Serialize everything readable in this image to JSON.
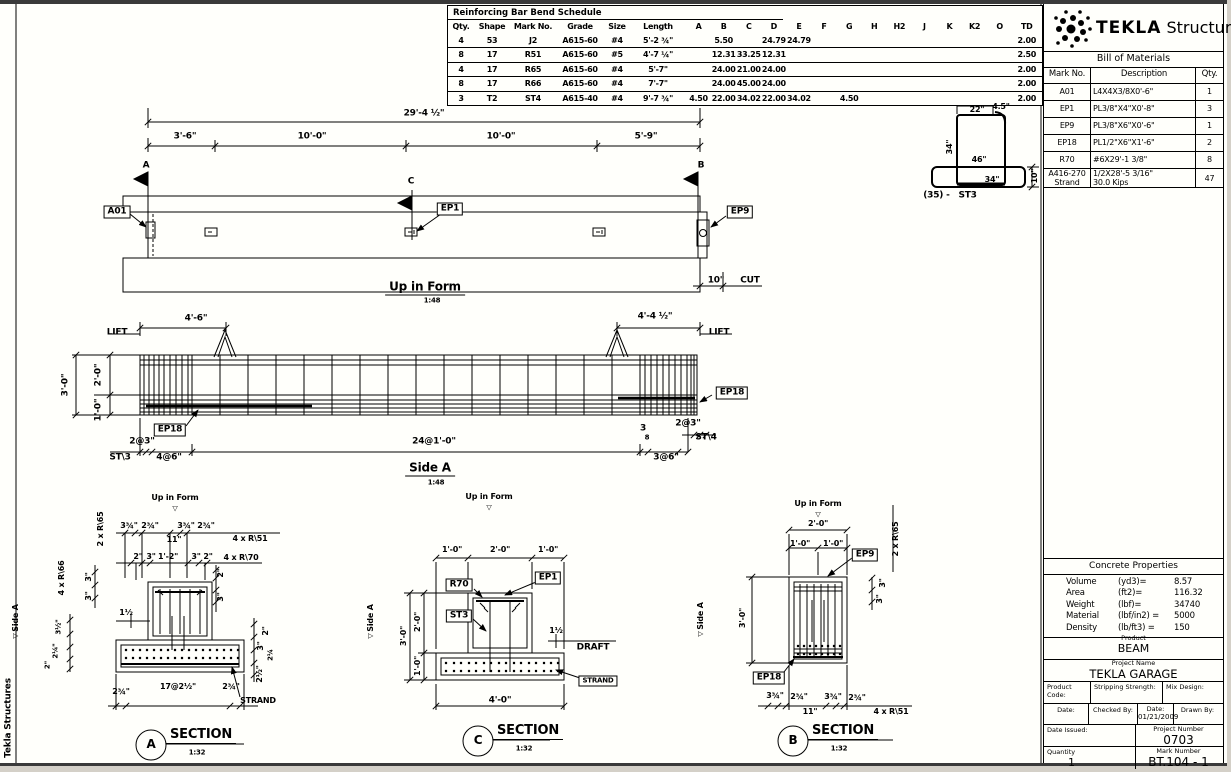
{
  "schedule": {
    "title": "Reinforcing Bar Bend Schedule",
    "head": [
      [
        "Qty.",
        "Shape",
        "Mark No.",
        "Grade",
        "Size",
        "Length",
        "A",
        "B",
        "C",
        "D",
        "E",
        "F",
        "G",
        "H",
        "H2",
        "J",
        "K",
        "K2",
        "O",
        "TD"
      ]
    ],
    "rows": [
      [
        "4",
        "53",
        "J2",
        "A615-60",
        "#4",
        "5'-2 ¾\"",
        "",
        "5.50",
        "",
        "24.79",
        "24.79",
        "",
        "",
        "",
        "",
        "",
        "",
        "",
        "",
        "2.00"
      ],
      [
        "8",
        "17",
        "R51",
        "A615-60",
        "#5",
        "4'-7 ¼\"",
        "",
        "12.31",
        "33.25",
        "12.31",
        "",
        "",
        "",
        "",
        "",
        "",
        "",
        "",
        "",
        "2.50"
      ],
      [
        "4",
        "17",
        "R65",
        "A615-60",
        "#4",
        "5'-7\"",
        "",
        "24.00",
        "21.00",
        "24.00",
        "",
        "",
        "",
        "",
        "",
        "",
        "",
        "",
        "",
        "2.00"
      ],
      [
        "8",
        "17",
        "R66",
        "A615-60",
        "#4",
        "7'-7\"",
        "",
        "24.00",
        "45.00",
        "24.00",
        "",
        "",
        "",
        "",
        "",
        "",
        "",
        "",
        "",
        "2.00"
      ],
      [
        "3",
        "T2",
        "ST4",
        "A615-40",
        "#4",
        "9'-7 ¾\"",
        "4.50",
        "22.00",
        "34.02",
        "22.00",
        "34.02",
        "",
        "4.50",
        "",
        "",
        "",
        "",
        "",
        "",
        "2.00"
      ]
    ]
  },
  "brand": {
    "name_bold": "TEKLA",
    "name_light": " Structures"
  },
  "bom": {
    "title": "Bill of Materials",
    "head": [
      [
        "Mark No.",
        "Description",
        "Qty."
      ]
    ],
    "rows": [
      [
        "A01",
        "L4X4X3/8X0'-6\"",
        "1"
      ],
      [
        "EP1",
        "PL3/8\"X4\"X0'-8\"",
        "3"
      ],
      [
        "EP9",
        "PL3/8\"X6\"X0'-6\"",
        "1"
      ],
      [
        "EP18",
        "PL1/2\"X6\"X1'-6\"",
        "2"
      ],
      [
        "R70",
        "#6X29'-1 3/8\"",
        "8"
      ],
      [
        "A416-270\nStrand",
        "1/2X28'-5 3/16\"\n30.0 Kips",
        "47"
      ]
    ]
  },
  "concrete": {
    "title": "Concrete Properties",
    "rows": [
      [
        "Volume",
        "(yd3)=",
        "8.57"
      ],
      [
        "Area",
        "(ft2)=",
        "116.32"
      ],
      [
        "Weight",
        "(lbf)=",
        "34740"
      ],
      [
        "Material",
        "(lbf/in2) =",
        "5000"
      ],
      [
        "Density",
        "(lb/ft3) =",
        "150"
      ]
    ]
  },
  "titleblock": {
    "product_label": "Product",
    "product": "BEAM",
    "project_label": "Project Name",
    "project": "TEKLA GARAGE",
    "product_code_label": "Product Code:",
    "stripping_label": "Stripping Strength:",
    "mix_label": "Mix Design:",
    "date_label": "Date:",
    "checked_label": "Checked By:",
    "date2_label": "Date:",
    "date2": "01/21/2009",
    "drawn_label": "Drawn By:",
    "date_issued_label": "Date Issued:",
    "project_number_label": "Project Number",
    "project_number": "0703",
    "quantity_label": "Quantity",
    "quantity": "1",
    "mark_number_label": "Mark Number",
    "mark_number": "BT.104 - 1"
  },
  "annotations": [
    {
      "n": "dim-overall-length",
      "t": "29'-4 ½\"",
      "x": 424,
      "y": 114
    },
    {
      "n": "dim-seg-1",
      "t": "3'-6\"",
      "x": 185,
      "y": 137
    },
    {
      "n": "dim-seg-2",
      "t": "10'-0\"",
      "x": 312,
      "y": 137
    },
    {
      "n": "dim-seg-3",
      "t": "10'-0\"",
      "x": 501,
      "y": 137
    },
    {
      "n": "dim-seg-4",
      "t": "5'-9\"",
      "x": 646,
      "y": 137
    },
    {
      "n": "section-mark-a",
      "t": "A",
      "x": 146,
      "y": 166
    },
    {
      "n": "section-mark-c",
      "t": "C",
      "x": 411,
      "y": 182
    },
    {
      "n": "section-mark-b",
      "t": "B",
      "x": 701,
      "y": 166
    },
    {
      "n": "label-a01",
      "t": "A01",
      "x": 117,
      "y": 212,
      "box": 1
    },
    {
      "n": "label-ep1",
      "t": "EP1",
      "x": 450,
      "y": 209,
      "box": 1
    },
    {
      "n": "label-ep9",
      "t": "EP9",
      "x": 740,
      "y": 212,
      "box": 1
    },
    {
      "n": "title-up-in-form",
      "t": "Up in Form",
      "x": 425,
      "y": 288,
      "s": 12,
      "u": 1
    },
    {
      "n": "scale-up-in-form",
      "t": "1:48",
      "x": 432,
      "y": 301,
      "s": 7
    },
    {
      "n": "dim-cut",
      "t": "10\"",
      "x": 716,
      "y": 281
    },
    {
      "n": "label-cut",
      "t": "CUT",
      "x": 750,
      "y": 281
    },
    {
      "n": "label-lift-left",
      "t": "LIFT",
      "x": 117,
      "y": 333
    },
    {
      "n": "dim-lift-left",
      "t": "4'-6\"",
      "x": 196,
      "y": 319
    },
    {
      "n": "dim-lift-right",
      "t": "4'-4 ½\"",
      "x": 655,
      "y": 317
    },
    {
      "n": "label-lift-right",
      "t": "LIFT",
      "x": 719,
      "y": 333
    },
    {
      "n": "dim-sidea-depth",
      "t": "3'-0\"",
      "x": 66,
      "y": 385,
      "r": 1
    },
    {
      "n": "dim-sidea-upper",
      "t": "2'-0\"",
      "x": 99,
      "y": 375,
      "r": 1
    },
    {
      "n": "dim-sidea-lower",
      "t": "1'-0\"",
      "x": 99,
      "y": 410,
      "r": 1
    },
    {
      "n": "label-ep18-sidea-left",
      "t": "EP18",
      "x": 170,
      "y": 430,
      "box": 1
    },
    {
      "n": "label-ep18-sidea-right",
      "t": "EP18",
      "x": 732,
      "y": 393,
      "box": 1
    },
    {
      "n": "dim-spacing-left-1",
      "t": "2@3\"",
      "x": 142,
      "y": 442
    },
    {
      "n": "label-st3-sidea",
      "t": "ST\\3",
      "x": 120,
      "y": 458
    },
    {
      "n": "dim-spacing-left-2",
      "t": "4@6\"",
      "x": 169,
      "y": 458
    },
    {
      "n": "dim-spacing-mid",
      "t": "24@1'-0\"",
      "x": 434,
      "y": 442
    },
    {
      "n": "dim-gap-num",
      "t": "3",
      "x": 643,
      "y": 429,
      "s": 9
    },
    {
      "n": "dim-gap-den",
      "t": "8",
      "x": 647,
      "y": 438,
      "s": 7
    },
    {
      "n": "dim-spacing-right-2",
      "t": "3@6\"",
      "x": 666,
      "y": 458
    },
    {
      "n": "dim-spacing-right-1",
      "t": "2@3\"",
      "x": 688,
      "y": 424
    },
    {
      "n": "label-st4-sidea",
      "t": "ST\\4",
      "x": 706,
      "y": 438
    },
    {
      "n": "title-side-a",
      "t": "Side A",
      "x": 430,
      "y": 469,
      "s": 12,
      "u": 1
    },
    {
      "n": "scale-side-a",
      "t": "1:48",
      "x": 436,
      "y": 483,
      "s": 7
    },
    {
      "n": "label-up-in-form-a",
      "t": "Up in Form",
      "x": 175,
      "y": 498,
      "s": 8
    },
    {
      "n": "up-arrow-a",
      "t": "▽",
      "x": 175,
      "y": 509,
      "s": 7
    },
    {
      "n": "label-2xr65-a",
      "t": "2 x R\\65",
      "x": 101,
      "y": 529,
      "r": 1,
      "s": 8
    },
    {
      "n": "dim-a-top-1",
      "t": "3¾\"",
      "x": 129,
      "y": 526,
      "s": 8
    },
    {
      "n": "dim-a-top-2",
      "t": "2¾\"",
      "x": 150,
      "y": 526,
      "s": 8
    },
    {
      "n": "dim-a-top-11",
      "t": "11\"",
      "x": 174,
      "y": 540,
      "s": 8
    },
    {
      "n": "dim-a-top-3",
      "t": "3¾\"",
      "x": 186,
      "y": 526,
      "s": 8
    },
    {
      "n": "dim-a-top-4",
      "t": "2¾\"",
      "x": 206,
      "y": 526,
      "s": 8
    },
    {
      "n": "label-4xr51-a",
      "t": "4 x R\\51",
      "x": 250,
      "y": 539,
      "s": 8
    },
    {
      "n": "dim-a-mid-1",
      "t": "2\"",
      "x": 138,
      "y": 557,
      "s": 8
    },
    {
      "n": "dim-a-mid-2",
      "t": "3\"",
      "x": 151,
      "y": 557,
      "s": 8
    },
    {
      "n": "dim-a-mid-3",
      "t": "1'-2\"",
      "x": 168,
      "y": 557,
      "s": 8
    },
    {
      "n": "dim-a-mid-4",
      "t": "3\"",
      "x": 196,
      "y": 557,
      "s": 8
    },
    {
      "n": "dim-a-mid-5",
      "t": "2\"",
      "x": 208,
      "y": 557,
      "s": 8
    },
    {
      "n": "label-4xr70-a",
      "t": "4 x R\\70",
      "x": 241,
      "y": 558,
      "s": 8
    },
    {
      "n": "dim-a-left-3a",
      "t": "3\"",
      "x": 89,
      "y": 577,
      "r": 1,
      "s": 8
    },
    {
      "n": "dim-a-left-3b",
      "t": "3\"",
      "x": 89,
      "y": 596,
      "r": 1,
      "s": 8
    },
    {
      "n": "label-4xr66-a",
      "t": "4 x R\\66",
      "x": 62,
      "y": 578,
      "r": 1,
      "s": 8
    },
    {
      "n": "dim-a-right-2",
      "t": "2\"",
      "x": 221,
      "y": 573,
      "r": 1,
      "s": 8
    },
    {
      "n": "dim-a-right-3",
      "t": "3\"",
      "x": 221,
      "y": 597,
      "r": 1,
      "s": 8
    },
    {
      "n": "dim-a-draft",
      "t": "1½",
      "x": 126,
      "y": 613,
      "s": 8
    },
    {
      "n": "dim-a-strand-r1",
      "t": "2\"",
      "x": 266,
      "y": 631,
      "r": 1,
      "s": 8
    },
    {
      "n": "dim-a-strand-r2",
      "t": "3\"",
      "x": 261,
      "y": 646,
      "r": 1,
      "s": 8
    },
    {
      "n": "dim-a-strand-r3",
      "t": "2¼",
      "x": 271,
      "y": 655,
      "r": 1,
      "s": 7
    },
    {
      "n": "dim-a-strand-r4",
      "t": "2½\"",
      "x": 260,
      "y": 674,
      "r": 1,
      "s": 8
    },
    {
      "n": "dim-a-strand-l1",
      "t": "3½\"",
      "x": 59,
      "y": 627,
      "r": 1,
      "s": 7
    },
    {
      "n": "dim-a-strand-l2",
      "t": "2¼\"",
      "x": 56,
      "y": 651,
      "r": 1,
      "s": 7
    },
    {
      "n": "dim-a-strand-l3",
      "t": "2\"",
      "x": 48,
      "y": 665,
      "r": 1,
      "s": 7
    },
    {
      "n": "dim-a-bot-1",
      "t": "2¾\"",
      "x": 121,
      "y": 692,
      "s": 8
    },
    {
      "n": "dim-a-bot-2",
      "t": "17@2½\"",
      "x": 178,
      "y": 687,
      "s": 8
    },
    {
      "n": "dim-a-bot-3",
      "t": "2¾\"",
      "x": 231,
      "y": 687,
      "s": 8
    },
    {
      "n": "label-strand-a",
      "t": "STRAND",
      "x": 258,
      "y": 701,
      "s": 8
    },
    {
      "n": "section-a-letter",
      "t": "A",
      "x": 151,
      "y": 744,
      "s": 12
    },
    {
      "n": "section-a-title",
      "t": "SECTION",
      "x": 201,
      "y": 736,
      "s": 13,
      "u": 1
    },
    {
      "n": "section-a-scale",
      "t": "1:32",
      "x": 197,
      "y": 753,
      "s": 7
    },
    {
      "n": "marker-side-a-1",
      "t": "Side A",
      "x": 16,
      "y": 618,
      "r": 1,
      "s": 8
    },
    {
      "n": "marker-side-a-1t",
      "t": "▽",
      "x": 16,
      "y": 636,
      "r": 1,
      "s": 7
    },
    {
      "n": "marker-side-a-2",
      "t": "Side A",
      "x": 371,
      "y": 618,
      "r": 1,
      "s": 8
    },
    {
      "n": "marker-side-a-2t",
      "t": "▽",
      "x": 371,
      "y": 636,
      "r": 1,
      "s": 7
    },
    {
      "n": "label-up-in-form-c",
      "t": "Up in Form",
      "x": 489,
      "y": 497,
      "s": 8
    },
    {
      "n": "up-arrow-c",
      "t": "▽",
      "x": 489,
      "y": 508,
      "s": 7
    },
    {
      "n": "dim-c-top-1",
      "t": "1'-0\"",
      "x": 452,
      "y": 550,
      "s": 8
    },
    {
      "n": "dim-c-top-2",
      "t": "2'-0\"",
      "x": 500,
      "y": 550,
      "s": 8
    },
    {
      "n": "dim-c-top-3",
      "t": "1'-0\"",
      "x": 548,
      "y": 550,
      "s": 8
    },
    {
      "n": "label-r70-c",
      "t": "R70",
      "x": 459,
      "y": 585,
      "box": 1
    },
    {
      "n": "label-ep1-c",
      "t": "EP1",
      "x": 548,
      "y": 578,
      "box": 1
    },
    {
      "n": "label-st3-c",
      "t": "ST3",
      "x": 459,
      "y": 616,
      "box": 1
    },
    {
      "n": "dim-c-depth",
      "t": "3'-0\"",
      "x": 404,
      "y": 636,
      "r": 1,
      "s": 8
    },
    {
      "n": "dim-c-upper",
      "t": "2'-0\"",
      "x": 418,
      "y": 622,
      "r": 1,
      "s": 8
    },
    {
      "n": "dim-c-lower",
      "t": "1'-0\"",
      "x": 418,
      "y": 666,
      "r": 1,
      "s": 8
    },
    {
      "n": "dim-c-draft",
      "t": "1½",
      "x": 556,
      "y": 631,
      "s": 8
    },
    {
      "n": "label-draft-c",
      "t": "DRAFT",
      "x": 593,
      "y": 648,
      "s": 9
    },
    {
      "n": "label-strand-c",
      "t": "STRAND",
      "x": 598,
      "y": 681,
      "box": 1,
      "s": 7
    },
    {
      "n": "dim-c-bot",
      "t": "4'-0\"",
      "x": 500,
      "y": 701,
      "s": 9
    },
    {
      "n": "section-c-letter",
      "t": "C",
      "x": 478,
      "y": 740,
      "s": 12
    },
    {
      "n": "section-c-title",
      "t": "SECTION",
      "x": 528,
      "y": 732,
      "s": 13,
      "u": 1
    },
    {
      "n": "section-c-scale",
      "t": "1:32",
      "x": 524,
      "y": 749,
      "s": 7
    },
    {
      "n": "marker-side-a-3",
      "t": "Side A",
      "x": 701,
      "y": 616,
      "r": 1,
      "s": 8
    },
    {
      "n": "marker-side-a-3t",
      "t": "▽",
      "x": 701,
      "y": 634,
      "r": 1,
      "s": 7
    },
    {
      "n": "label-up-in-form-b",
      "t": "Up in Form",
      "x": 818,
      "y": 504,
      "s": 8
    },
    {
      "n": "up-arrow-b",
      "t": "▽",
      "x": 818,
      "y": 515,
      "s": 7
    },
    {
      "n": "dim-b-top",
      "t": "2'-0\"",
      "x": 818,
      "y": 524,
      "s": 8
    },
    {
      "n": "dim-b-top-1",
      "t": "1'-0\"",
      "x": 800,
      "y": 544,
      "s": 8
    },
    {
      "n": "dim-b-top-2",
      "t": "1'-0\"",
      "x": 833,
      "y": 544,
      "s": 8
    },
    {
      "n": "label-ep9-b",
      "t": "EP9",
      "x": 865,
      "y": 555,
      "box": 1
    },
    {
      "n": "label-2xr65-b",
      "t": "2 x R\\65",
      "x": 896,
      "y": 539,
      "r": 1,
      "s": 8
    },
    {
      "n": "dim-b-right-3a",
      "t": "3\"",
      "x": 883,
      "y": 583,
      "r": 1,
      "s": 8
    },
    {
      "n": "dim-b-right-3b",
      "t": "3\"",
      "x": 880,
      "y": 599,
      "r": 1,
      "s": 8
    },
    {
      "n": "dim-b-depth",
      "t": "3'-0\"",
      "x": 743,
      "y": 618,
      "r": 1,
      "s": 8
    },
    {
      "n": "label-ep18-b",
      "t": "EP18",
      "x": 769,
      "y": 678,
      "box": 1
    },
    {
      "n": "dim-b-bot-1",
      "t": "3¾\"",
      "x": 775,
      "y": 696,
      "s": 8
    },
    {
      "n": "dim-b-bot-2",
      "t": "2¾\"",
      "x": 799,
      "y": 697,
      "s": 8
    },
    {
      "n": "dim-b-bot-11",
      "t": "11\"",
      "x": 810,
      "y": 712,
      "s": 8
    },
    {
      "n": "dim-b-bot-3",
      "t": "3¾\"",
      "x": 833,
      "y": 697,
      "s": 8
    },
    {
      "n": "dim-b-bot-4",
      "t": "2¾\"",
      "x": 857,
      "y": 698,
      "s": 8
    },
    {
      "n": "label-4xr51-b",
      "t": "4 x R\\51",
      "x": 891,
      "y": 712,
      "s": 8
    },
    {
      "n": "section-b-letter",
      "t": "B",
      "x": 793,
      "y": 740,
      "s": 12
    },
    {
      "n": "section-b-title",
      "t": "SECTION",
      "x": 843,
      "y": 732,
      "s": 13,
      "u": 1
    },
    {
      "n": "section-b-scale",
      "t": "1:32",
      "x": 839,
      "y": 749,
      "s": 7
    },
    {
      "n": "dim-st3-22",
      "t": "22\"",
      "x": 977,
      "y": 110,
      "s": 8
    },
    {
      "n": "dim-st3-45",
      "t": "4.5\"",
      "x": 1001,
      "y": 107,
      "s": 8
    },
    {
      "n": "dim-st3-34v",
      "t": "34\"",
      "x": 950,
      "y": 147,
      "r": 1,
      "s": 8
    },
    {
      "n": "dim-st3-46",
      "t": "46\"",
      "x": 979,
      "y": 160,
      "s": 8
    },
    {
      "n": "dim-st3-34b",
      "t": "34\"",
      "x": 992,
      "y": 180,
      "s": 8
    },
    {
      "n": "dim-st3-10",
      "t": "10\"",
      "x": 1035,
      "y": 176,
      "r": 1,
      "s": 8
    },
    {
      "n": "label-st3-shape",
      "t": "(35) -   ST3",
      "x": 950,
      "y": 196,
      "s": 9
    },
    {
      "n": "sheet-side-label",
      "t": "Tekla Structures",
      "x": 9,
      "y": 718,
      "r": 1,
      "s": 9
    }
  ]
}
